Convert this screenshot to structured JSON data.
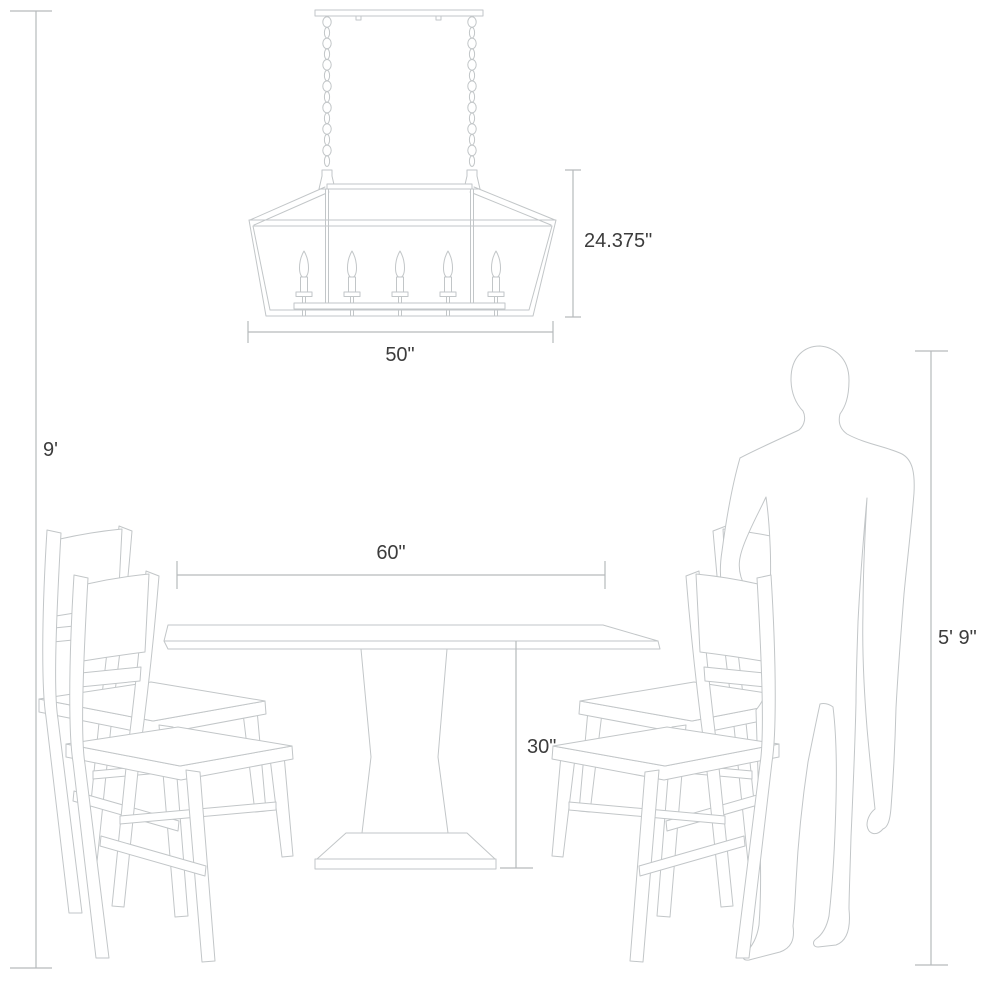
{
  "diagram": {
    "labels": {
      "ceiling_height": "9'",
      "fixture_height": "24.375\"",
      "fixture_width": "50\"",
      "table_width": "60\"",
      "table_height": "30\"",
      "person_height": "5' 9\""
    },
    "chandelier": {
      "light_count": 5,
      "chain_count": 2
    },
    "colors": {
      "line": "#c2c6c8",
      "dimension": "#b6babc",
      "text": "#3c3c3c"
    }
  }
}
